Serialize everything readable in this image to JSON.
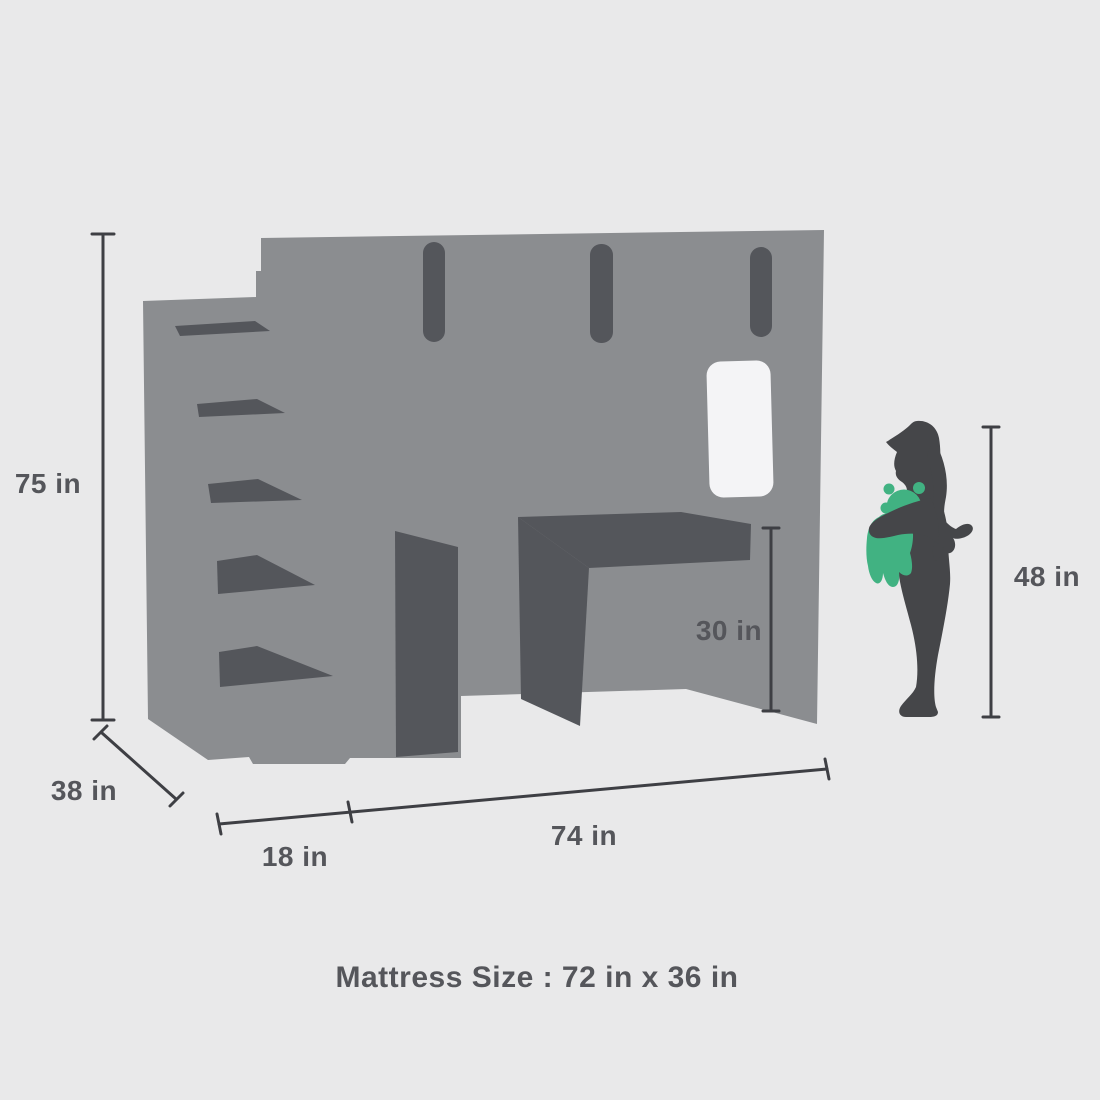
{
  "diagram": {
    "caption": "Mattress Size : 72 in x 36 in",
    "dimensions": [
      {
        "id": "bed-height",
        "label": "75 in"
      },
      {
        "id": "bed-depth",
        "label": "38 in"
      },
      {
        "id": "stair-depth",
        "label": "18 in"
      },
      {
        "id": "bed-length",
        "label": "74 in"
      },
      {
        "id": "desk-clearance",
        "label": "30 in"
      },
      {
        "id": "child-height",
        "label": "48 in"
      }
    ],
    "figures": {
      "furniture": "loft-bed-with-stairs-desk-and-window",
      "scale_figure": "child-holding-teddy-bear"
    },
    "colors": {
      "background": "#e9e9ea",
      "bed": "#8b8d90",
      "bed_dark": "#54565b",
      "window": "#f4f4f6",
      "child": "#454649",
      "teddy": "#41b282",
      "line": "#3e3f44",
      "label": "#55565b"
    }
  }
}
